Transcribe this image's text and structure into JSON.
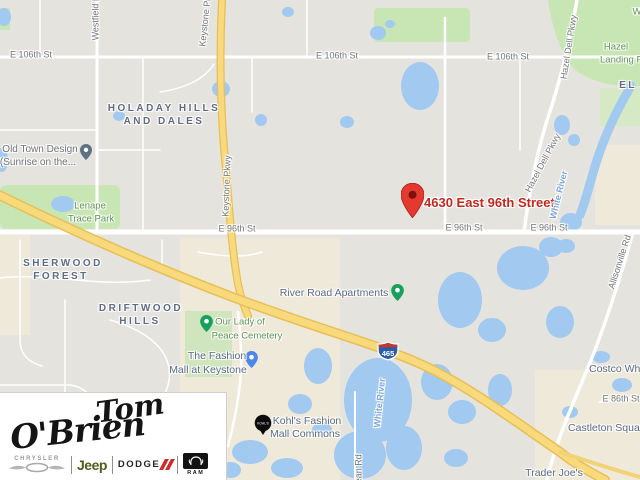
{
  "map": {
    "marker": {
      "label": "4630 East 96th Street"
    },
    "shield": {
      "route": "465"
    },
    "labels": [
      {
        "name": "street-label-106th-west",
        "type": "street",
        "text": "E 106th St",
        "x": 31,
        "y": 55
      },
      {
        "name": "street-label-106th-mid",
        "type": "street",
        "text": "E 106th St",
        "x": 337,
        "y": 56
      },
      {
        "name": "street-label-106th-east",
        "type": "street",
        "text": "E 106th St",
        "x": 508,
        "y": 57
      },
      {
        "name": "street-label-96th-west",
        "type": "street",
        "text": "E 96th St",
        "x": 237,
        "y": 229
      },
      {
        "name": "street-label-96th-mid",
        "type": "street",
        "text": "E 96th St",
        "x": 464,
        "y": 228
      },
      {
        "name": "street-label-96th-east",
        "type": "street",
        "text": "E 96th St",
        "x": 549,
        "y": 228
      },
      {
        "name": "street-label-keystone-top",
        "type": "street",
        "text": "Keystone Pkwy",
        "x": 206,
        "y": 16,
        "rot": -84
      },
      {
        "name": "street-label-keystone-mid",
        "type": "street",
        "text": "Keystone Pkwy",
        "x": 227,
        "y": 186,
        "rot": -88
      },
      {
        "name": "street-label-westfield",
        "type": "street",
        "text": "Westfield Blvd",
        "x": 96,
        "y": 12,
        "rot": -90
      },
      {
        "name": "street-label-hazel-dell-top",
        "type": "street",
        "text": "Hazel Dell Pkwy",
        "x": 569,
        "y": 47,
        "rot": -81
      },
      {
        "name": "street-label-hazel-dell-mid",
        "type": "street",
        "text": "Hazel Dell Pkwy",
        "x": 543,
        "y": 163,
        "rot": -62
      },
      {
        "name": "street-label-allisonville",
        "type": "street",
        "text": "Allisonville Rd",
        "x": 620,
        "y": 262,
        "rot": -72
      },
      {
        "name": "street-label-86th",
        "type": "street",
        "text": "E 86th St",
        "x": 621,
        "y": 399
      },
      {
        "name": "street-label-dean",
        "type": "street",
        "text": "Dean Rd",
        "x": 359,
        "y": 472,
        "rot": -90
      },
      {
        "name": "river-label-north",
        "type": "river",
        "text": "White River",
        "x": 559,
        "y": 195,
        "rot": -76
      },
      {
        "name": "river-label-south",
        "type": "river",
        "text": "White River",
        "x": 380,
        "y": 403,
        "rot": -84
      },
      {
        "name": "neighborhood-holaday-1",
        "type": "hood",
        "text": "HOLADAY HILLS",
        "x": 164,
        "y": 109
      },
      {
        "name": "neighborhood-holaday-2",
        "type": "hood",
        "text": "AND DALES",
        "x": 164,
        "y": 122
      },
      {
        "name": "neighborhood-sherwood-1",
        "type": "hood",
        "text": "SHERWOOD",
        "x": 63,
        "y": 264
      },
      {
        "name": "neighborhood-sherwood-2",
        "type": "hood",
        "text": "FOREST",
        "x": 61,
        "y": 277
      },
      {
        "name": "neighborhood-driftwood-1",
        "type": "hood",
        "text": "DRIFTWOOD",
        "x": 141,
        "y": 309
      },
      {
        "name": "neighborhood-driftwood-2",
        "type": "hood",
        "text": "HILLS",
        "x": 140,
        "y": 322
      },
      {
        "name": "neighborhood-el-partial",
        "type": "hood",
        "text": "EL",
        "x": 628,
        "y": 86
      },
      {
        "name": "park-label-hazel-landing-1",
        "type": "park",
        "text": "Hazel",
        "x": 616,
        "y": 47
      },
      {
        "name": "park-label-hazel-landing-2",
        "type": "park",
        "text": "Landing Park",
        "x": 628,
        "y": 60
      },
      {
        "name": "park-label-w-partial",
        "type": "park",
        "text": "W",
        "x": 637,
        "y": 12
      },
      {
        "name": "park-label-lenape-1",
        "type": "park",
        "text": "Lenape",
        "x": 90,
        "y": 206
      },
      {
        "name": "park-label-lenape-2",
        "type": "park",
        "text": "Trace Park",
        "x": 91,
        "y": 219
      },
      {
        "name": "poi-label-cemetery-1",
        "type": "park",
        "text": "Our Lady of",
        "x": 240,
        "y": 322,
        "inter": true
      },
      {
        "name": "poi-label-cemetery-2",
        "type": "park",
        "text": "Peace Cemetery",
        "x": 247,
        "y": 336,
        "inter": true
      },
      {
        "name": "poi-label-old-town-1",
        "type": "poi",
        "text": "Old Town Design",
        "x": 40,
        "y": 150,
        "inter": true
      },
      {
        "name": "poi-label-old-town-2",
        "type": "poi",
        "text": "(Sunrise on the...",
        "x": 38,
        "y": 163,
        "inter": true
      },
      {
        "name": "poi-label-river-road-apartments",
        "type": "shop",
        "text": "River Road Apartments",
        "x": 334,
        "y": 293,
        "inter": true
      },
      {
        "name": "poi-label-fashion-mall-1",
        "type": "shop",
        "text": "The Fashion",
        "x": 217,
        "y": 356,
        "inter": true
      },
      {
        "name": "poi-label-fashion-mall-2",
        "type": "shop",
        "text": "Mall at Keystone",
        "x": 208,
        "y": 370,
        "inter": true
      },
      {
        "name": "poi-label-kohls-1",
        "type": "shop",
        "text": "Kohl's Fashion",
        "x": 307,
        "y": 421,
        "inter": true
      },
      {
        "name": "poi-label-kohls-2",
        "type": "shop",
        "text": "Mall Commons",
        "x": 305,
        "y": 434,
        "inter": true
      },
      {
        "name": "poi-label-castleton",
        "type": "shop",
        "text": "Castleton Square",
        "x": 568,
        "y": 428,
        "anchor": "left",
        "inter": true
      },
      {
        "name": "poi-label-costco",
        "type": "shop",
        "text": "Costco Wholesale",
        "x": 589,
        "y": 369,
        "anchor": "left",
        "inter": true
      },
      {
        "name": "poi-label-trader-joes",
        "type": "shop",
        "text": "Trader Joe's",
        "x": 554,
        "y": 473,
        "inter": true
      }
    ]
  },
  "logo": {
    "line1": "Tom",
    "line2": "O'Brien",
    "brands": {
      "chrysler": "CHRYSLER",
      "jeep": "Jeep",
      "dodge": "DODGE",
      "ram": "RAM"
    }
  }
}
